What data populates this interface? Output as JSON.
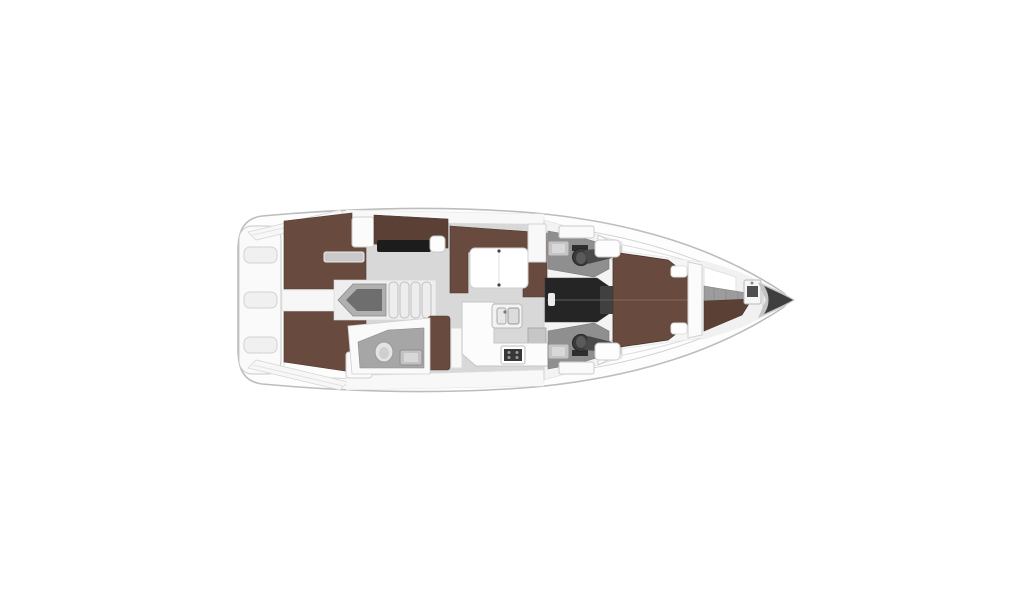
{
  "diagram": {
    "kind": "sailing yacht interior floor plan, top-down view",
    "orientation": {
      "stern": "left",
      "bow": "right",
      "port": "top",
      "starboard": "bottom"
    }
  },
  "colors": {
    "background": "#ffffff",
    "hull_fill": "#fdfdfd",
    "hull_stroke": "#bdbdbd",
    "deck_white": "#f7f7f7",
    "floor_gray": "#d8d8d8",
    "wood_brown": "#684a3e",
    "wood_brown_dark": "#5b4036",
    "head_floor_gray": "#8f8f8f",
    "aft_head_floor_gray": "#a6a6a6",
    "corridor_dark": "#252525",
    "chart_table_black": "#1c1c1c",
    "stove_dark": "#383838",
    "bow_cone": "#3f3f3f",
    "stairs_inner_gray": "#6e6e6e",
    "stairs_pod_gray": "#b0b0b0",
    "steps_gray": "#9c9c9c",
    "shelf_gray": "#c9c9c9",
    "toilet_dark": "#3a3a3a",
    "wardrobe_dark": "#4a4a4a"
  },
  "areas": [
    {
      "id": "stern-platform",
      "label": "stern swim platform with three steps"
    },
    {
      "id": "aft-cabin-port",
      "label": "aft double cabin, port side"
    },
    {
      "id": "aft-cabin-starboard",
      "label": "aft double cabin, starboard side"
    },
    {
      "id": "stern-corridor",
      "label": "corridor between aft cabins"
    },
    {
      "id": "companionway-stairs",
      "label": "companionway stairs with treads"
    },
    {
      "id": "nav-station",
      "label": "navigation station with chart table and seat"
    },
    {
      "id": "salon-settee",
      "label": "U-shaped salon settee with folding table"
    },
    {
      "id": "galley",
      "label": "L-shaped galley with double sink and stove"
    },
    {
      "id": "galley-bench",
      "label": "galley bench seat"
    },
    {
      "id": "aft-head",
      "label": "aft head with toilet and basin"
    },
    {
      "id": "port-head",
      "label": "port head with toilet, basin and cabinet"
    },
    {
      "id": "starboard-head",
      "label": "starboard head with toilet, basin and cabinet"
    },
    {
      "id": "passageway",
      "label": "dark passageway to owner's cabin"
    },
    {
      "id": "owners-cabin",
      "label": "forward owner's cabin with island berth and pillows"
    },
    {
      "id": "forepeak",
      "label": "forepeak with step block, sole and basin"
    },
    {
      "id": "bow",
      "label": "bow cone / anchor locker"
    }
  ]
}
